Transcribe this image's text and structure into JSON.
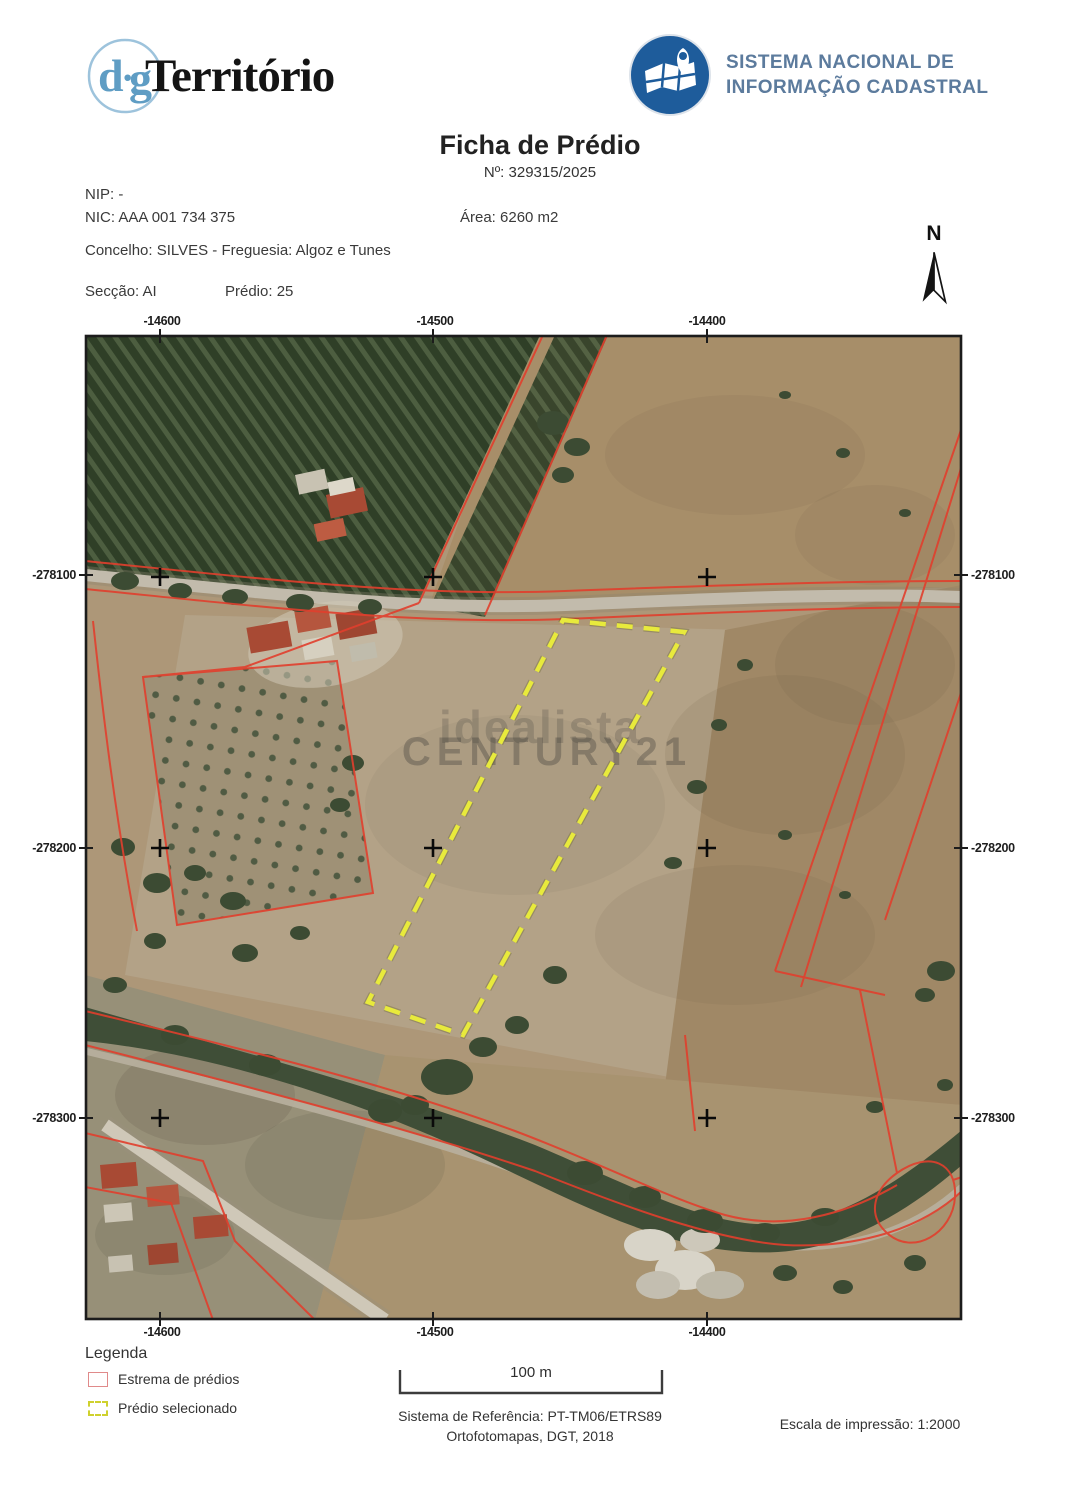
{
  "header": {
    "dg_logo": {
      "d": "d",
      "dot": "·",
      "g": "g",
      "name": "Território"
    },
    "snic": {
      "line1": "SISTEMA NACIONAL DE",
      "line2": "INFORMAÇÃO CADASTRAL"
    }
  },
  "title": {
    "main": "Ficha de Prédio",
    "number": "Nº: 329315/2025"
  },
  "details": {
    "nip": "NIP: -",
    "nic": "NIC: AAA 001 734 375",
    "area": "Área: 6260 m2",
    "concelho": "Concelho: SILVES - Freguesia: Algoz e Tunes",
    "seccao": "Secção: AI",
    "predio": "Prédio: 25"
  },
  "compass": {
    "north_label": "N"
  },
  "map": {
    "x_ticks": [
      "-14600",
      "-14500",
      "-14400"
    ],
    "y_ticks": [
      "-278100",
      "-278200",
      "-278300"
    ],
    "watermark_back": "idealista",
    "watermark_front": "CENTURY21"
  },
  "legend": {
    "title": "Legenda",
    "items": [
      {
        "label": "Estrema de prédios",
        "swatch": "red-outline"
      },
      {
        "label": "Prédio selecionado",
        "swatch": "yellow-dashed"
      }
    ]
  },
  "footer": {
    "scalebar_label": "100 m",
    "ref_line1": "Sistema de Referência: PT-TM06/ETRS89",
    "ref_line2": "Ortofotomapas, DGT, 2018",
    "print_scale": "Escala de impressão: 1:2000"
  },
  "colors": {
    "boundary_red": "#e13f2d",
    "selected_yellow": "#e8ea3c",
    "snic_blue": "#1e5c9b",
    "snic_text": "#5c7b9d",
    "dg_blue": "#5f9dc4"
  }
}
